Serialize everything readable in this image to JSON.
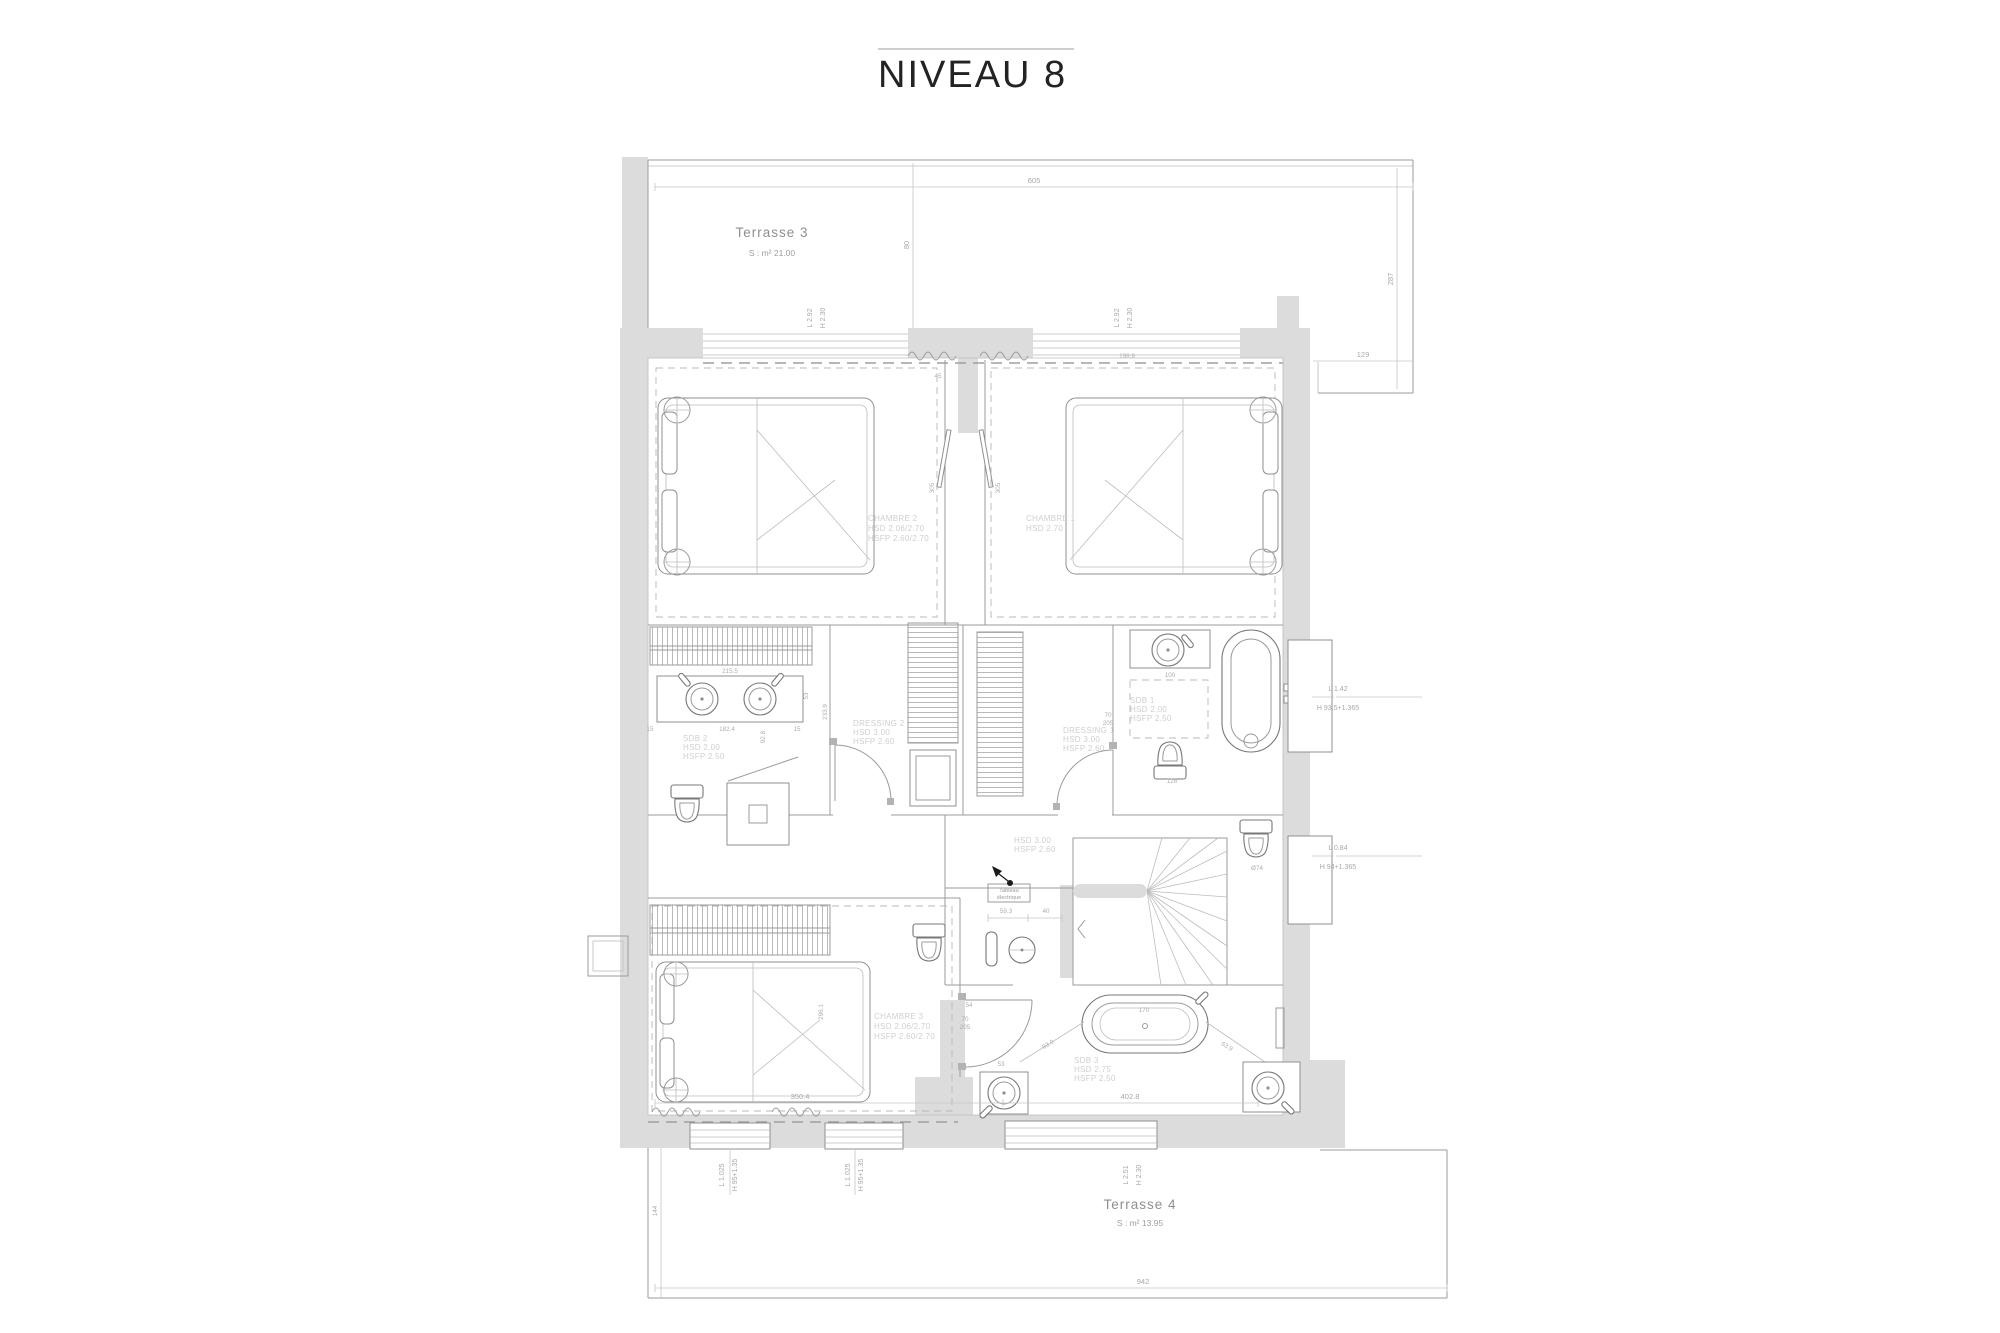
{
  "title": "NIVEAU 8",
  "colors": {
    "wall": "#dcdcdc",
    "line": "#8f8f8f",
    "faint_label": "#cfcfcf",
    "dim_text": "#a8a8a8",
    "title_text": "#232323"
  },
  "terrace3": {
    "name": "Terrasse 3",
    "area": "S : m² 21.00"
  },
  "terrace4": {
    "name": "Terrasse 4",
    "area": "S : m² 13.95"
  },
  "rooms": {
    "chambre2": {
      "name": "CHAMBRE 2",
      "hsd": "HSD 2.06/2.70",
      "hsfp": "HSFP 2.60/2.70"
    },
    "chambre1": {
      "name": "CHAMBRE 1",
      "hsd": "HSD 2.70"
    },
    "chambre3": {
      "name": "CHAMBRE 3",
      "hsd": "HSD 2.06/2.70",
      "hsfp": "HSFP 2.60/2.70"
    },
    "sdb2": {
      "name": "SDB 2",
      "hsd": "HSD 2.00",
      "hsfp": "HSFP 2.50"
    },
    "sdb1": {
      "name": "SDB 1",
      "hsd": "HSD 2.00",
      "hsfp": "HSFP 2.50"
    },
    "sdb3": {
      "name": "SDB 3",
      "hsd": "HSD 2.75",
      "hsfp": "HSFP 2.50"
    },
    "dressing2": {
      "name": "DRESSING 2",
      "hsd": "HSD 3.00",
      "hsfp": "HSFP 2.60"
    },
    "dressing1": {
      "name": "DRESSING 1",
      "hsd": "HSD 3.00",
      "hsfp": "HSFP 2.60"
    },
    "hall": {
      "hsd": "HSD 3.00",
      "hsfp": "HSFP 2.60"
    },
    "electrical_panel": {
      "line1": "Tableau",
      "line2": "électrique"
    }
  },
  "openings": {
    "window_top_left": {
      "l": "L 2.92",
      "h": "H 2.30"
    },
    "window_top_right": {
      "l": "L 2.92",
      "h": "H 2.30"
    },
    "bay_terrace4": {
      "l": "L 2.51",
      "h": "H 2.30"
    },
    "window_bottom_1": {
      "l": "L 1.025",
      "h": "H 95+1.35"
    },
    "window_bottom_2": {
      "l": "L 1.025",
      "h": "H 95+1.35"
    },
    "niche_bath": {
      "l": "L 1.42",
      "h": "H 93.5+1.365"
    },
    "niche_wc": {
      "l": "L 0.84",
      "h": "H 94+1.365"
    },
    "door_standard": {
      "w": "70",
      "h": "205"
    }
  },
  "dims": {
    "terrace3_width": "605",
    "terrace3_right": "287",
    "terrace3_step": "129",
    "terrace3_left": "80",
    "ceiling_line": "198.9",
    "pier": "45",
    "partition_left": "305",
    "partition_right": "305",
    "vanity2_top": "215.5",
    "vanity2_bottom": "182.4",
    "vanity2_depth": "53",
    "edge_left": "15",
    "edge_right": "15",
    "sdb2_height": "92.8",
    "dressing2_height": "233.9",
    "sink1_width": "100",
    "wc1_width": "128",
    "wc2_dia": "Ø74",
    "hall_a": "59.3",
    "hall_b": "40",
    "door_c3": "54",
    "chambre3_height": "296.1",
    "chambre3_width": "350.4",
    "sdb3_width": "402.8",
    "tub3_width": "170",
    "diag_left": "63.9",
    "diag_right": "63.9",
    "sink3_width": "53",
    "terrace4_left": "144",
    "terrace4_width": "942"
  }
}
